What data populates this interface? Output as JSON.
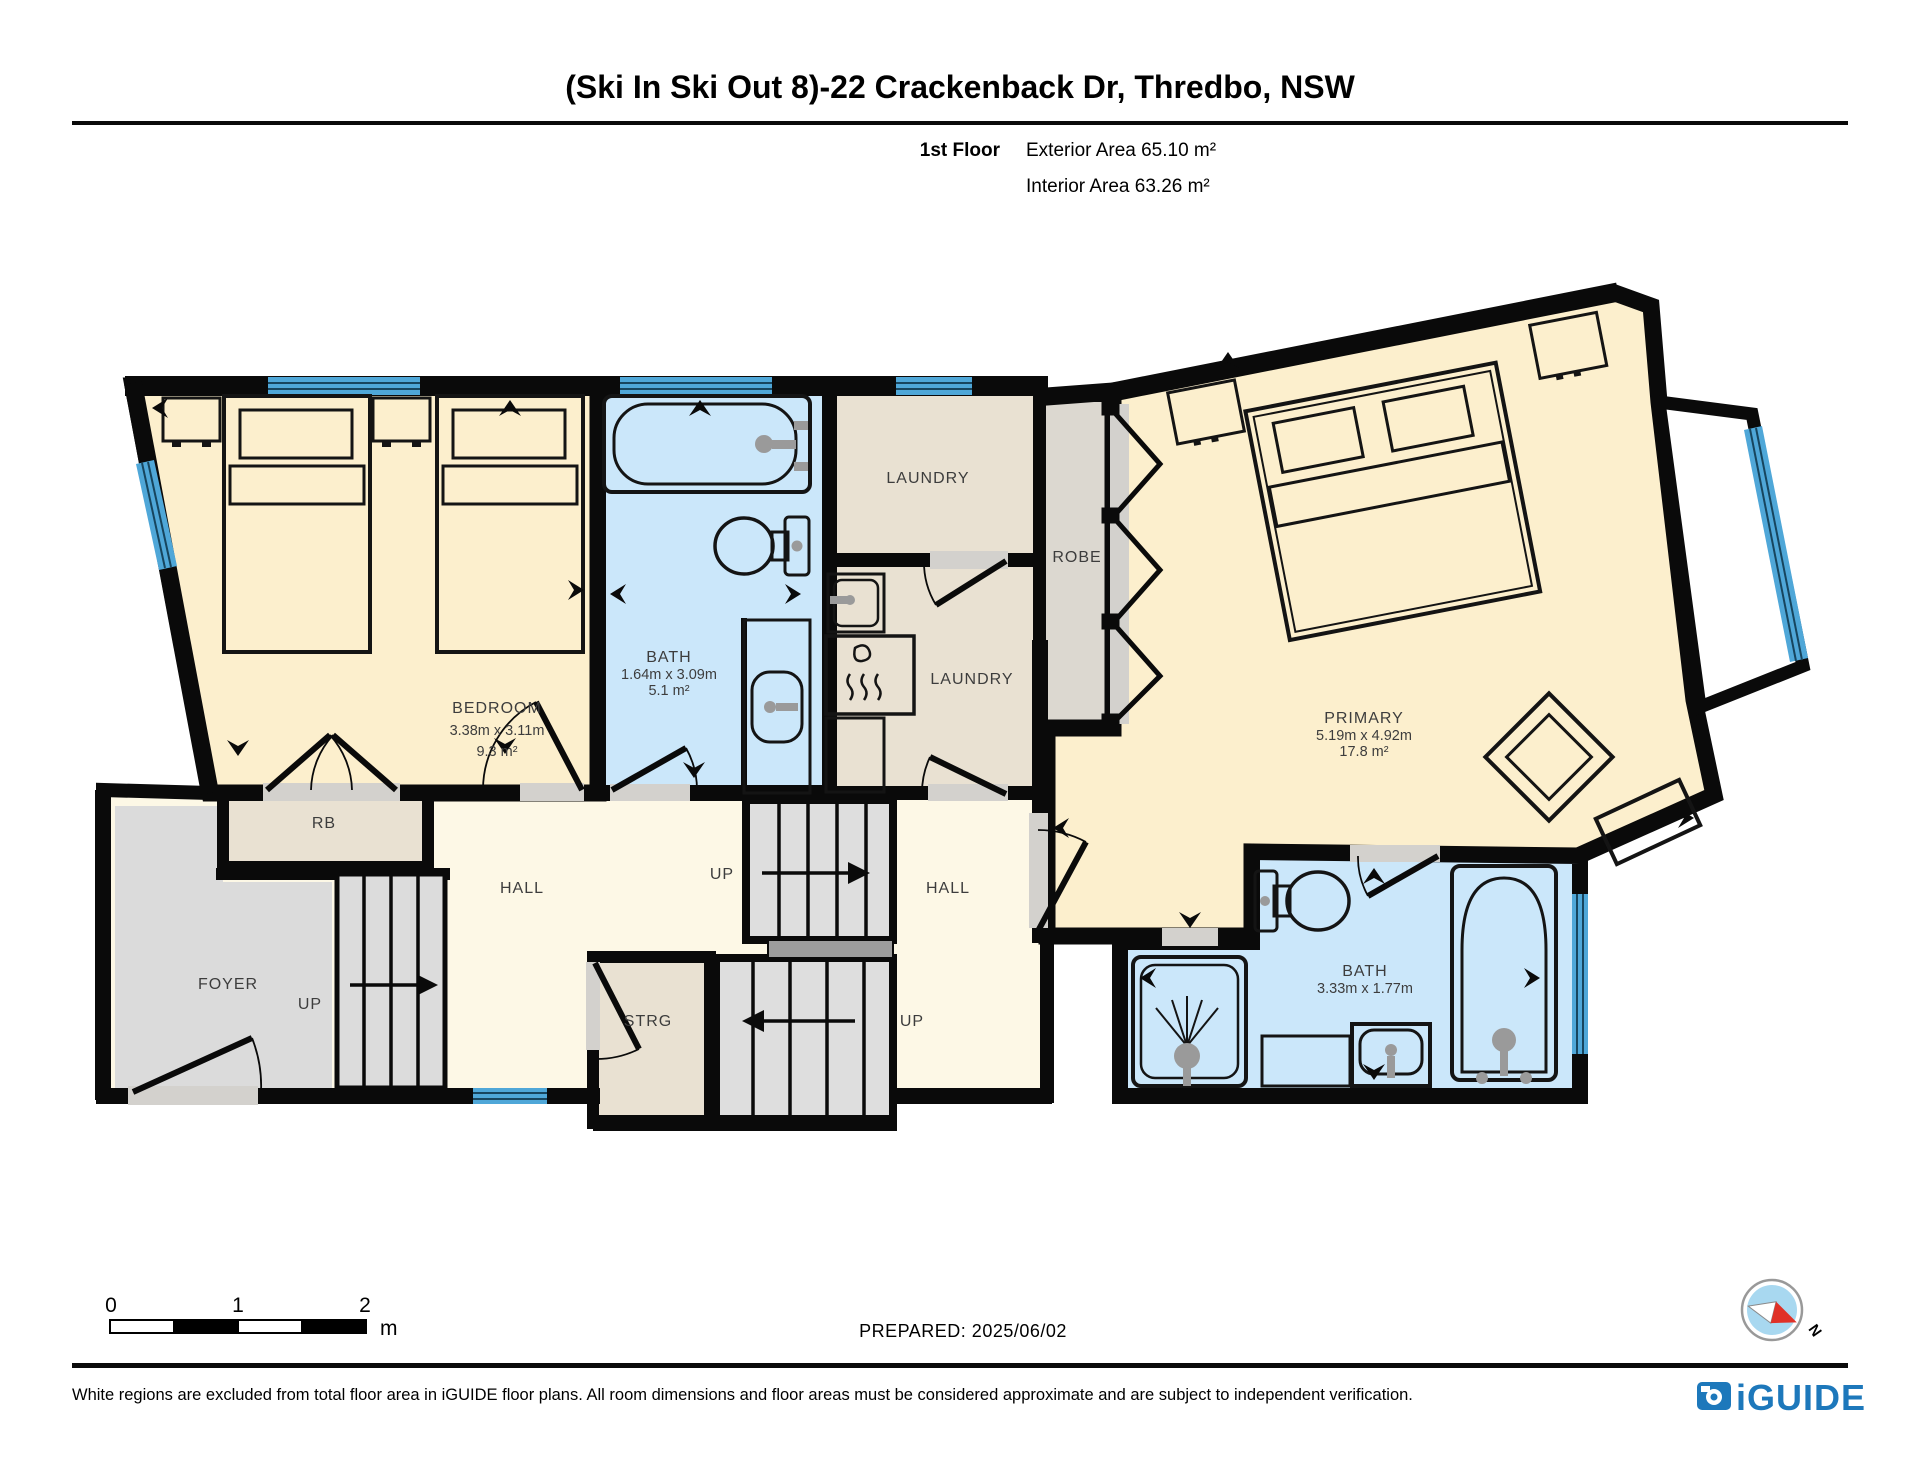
{
  "header": {
    "title": "(Ski In Ski Out 8)-22 Crackenback Dr, Thredbo, NSW",
    "floor_label": "1st Floor",
    "exterior_area": "Exterior Area 65.10 m²",
    "interior_area": "Interior Area 63.26 m²"
  },
  "rooms": {
    "bedroom": {
      "name": "BEDROOM",
      "dims": "3.38m x 3.11m",
      "area": "9.3 m²"
    },
    "bath1": {
      "name": "BATH",
      "dims": "1.64m x 3.09m",
      "area": "5.1 m²"
    },
    "laundry1": {
      "name": "LAUNDRY"
    },
    "laundry2": {
      "name": "LAUNDRY"
    },
    "robe": {
      "name": "ROBE"
    },
    "primary": {
      "name": "PRIMARY",
      "dims": "5.19m x 4.92m",
      "area": "17.8 m²"
    },
    "rb": {
      "name": "RB"
    },
    "hall_left": {
      "name": "HALL"
    },
    "hall_right": {
      "name": "HALL"
    },
    "foyer": {
      "name": "FOYER"
    },
    "strg": {
      "name": "STRG"
    },
    "bath2": {
      "name": "BATH",
      "dims": "3.33m x 1.77m"
    },
    "up_mid": "UP",
    "up_foyer": "UP",
    "up_right": "UP"
  },
  "scale_bar": {
    "tick0": "0",
    "tick1": "1",
    "tick2": "2",
    "unit": "m"
  },
  "prepared": "PREPARED: 2025/06/02",
  "compass": {
    "north_label": "N"
  },
  "footer": {
    "disclaimer": "White regions are excluded from total floor area in iGUIDE floor plans. All room dimensions and floor areas must be considered approximate and are subject to independent verification.",
    "brand": "iGUIDE"
  },
  "colors": {
    "wall": "#0a0a0a",
    "room_cream": "#fcefcd",
    "hall_cream": "#fdf8e6",
    "bath_blue": "#cbe7fa",
    "window_blue": "#4fa7d8",
    "laundry_tan": "#e9e1d2",
    "robe_gray": "#dcd8d0",
    "foyer_gray": "#dbdbdb",
    "stairs_gray": "#dedede",
    "landing_gray": "#9d9d9d",
    "threshold_gray": "#d3d1cd",
    "fixture_gray": "#9a9a9a",
    "brand_blue": "#1d78bb",
    "compass_blue": "#a8d8f0",
    "compass_red": "#e03127"
  }
}
